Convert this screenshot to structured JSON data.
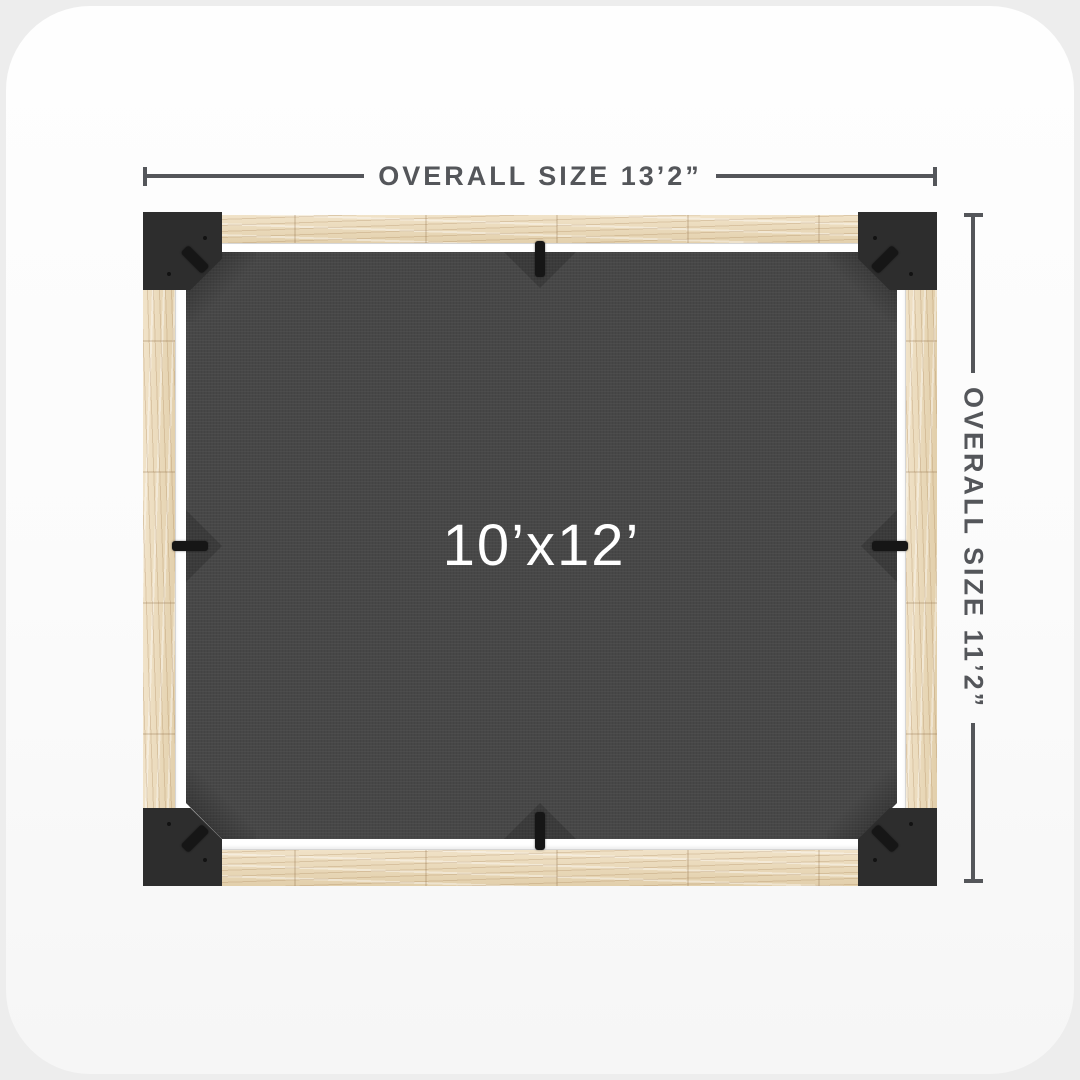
{
  "scene": {
    "top_dimension": {
      "label": "OVERALL SIZE 13’2”"
    },
    "right_dimension": {
      "label": "OVERALL SIZE 11’2”"
    },
    "canopy": {
      "size_label": "10’x12’"
    },
    "colors": {
      "dimension_line": "#54565A",
      "corner_bracket": "#2D2D2D",
      "canopy_fabric": "#474747",
      "canopy_label_text": "#FFFFFF",
      "wood_beam": "#E9D7B8",
      "rail": "#FFFFFF",
      "background": "#EDEDED",
      "card_background": "#FDFDFD"
    }
  }
}
